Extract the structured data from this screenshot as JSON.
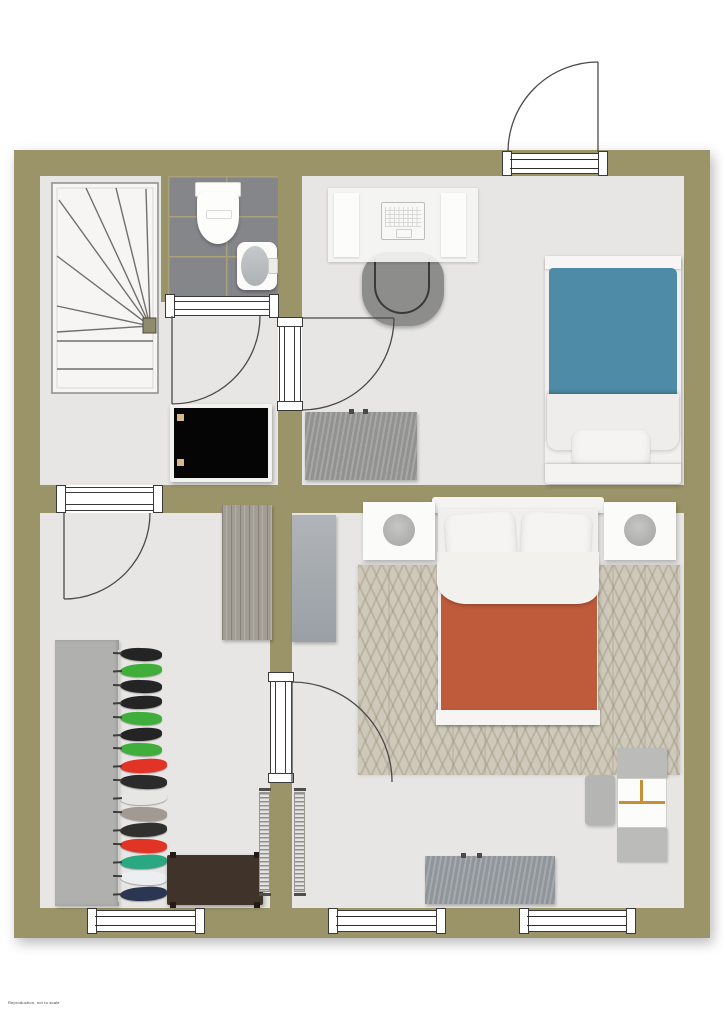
{
  "meta": {
    "type": "floor-plan",
    "description": "top-down residential floor plan, one level",
    "fine_print": "Reproduction, not to scale"
  },
  "palette": {
    "wall": "#9a9468",
    "floor": "#e7e6e4",
    "tile": "#85868a",
    "grout": "#aba079",
    "rug": "#cfc9bb",
    "teal": "#4d8ba6",
    "terracotta": "#bf5a3a",
    "tv": "#050505",
    "wood": "#a29e95",
    "bench_brown": "#40332a",
    "shelf_accent": "#c59038",
    "garment_green": "#3fae3b",
    "garment_red": "#e23327"
  },
  "openings": {
    "entrance_doors": 1,
    "interior_doors": 4,
    "windows": 3
  },
  "rooms": {
    "landing": {
      "name": "stair landing",
      "items": [
        "winder-staircase",
        "tv"
      ]
    },
    "bathroom": {
      "name": "bathroom",
      "items": [
        "toilet",
        "sink",
        "tiled-floor"
      ]
    },
    "study": {
      "name": "study bedroom",
      "items": [
        "desk",
        "laptop",
        "office-chair",
        "single-bed-teal",
        "dresser"
      ]
    },
    "hallway": {
      "name": "hallway",
      "items": [
        "open-wardrobe",
        "clothes-rail",
        "shoe-bench-brown",
        "radiator"
      ],
      "garment_colors": [
        "#242424",
        "#3fae3b",
        "#242424",
        "#242424",
        "#3fae3b",
        "#242424",
        "#3fae3b",
        "#e23327",
        "#2b2b2b",
        "#e6e6e4",
        "#a09a92",
        "#30302e",
        "#e23327",
        "#2aa882",
        "#eceff1",
        "#2b3752"
      ]
    },
    "master_bedroom": {
      "name": "bedroom",
      "items": [
        "double-bed-terracotta",
        "nightstand-left",
        "nightstand-right",
        "chevron-rug",
        "wardrobe",
        "shelf-unit",
        "stool",
        "bench",
        "radiator"
      ]
    }
  }
}
